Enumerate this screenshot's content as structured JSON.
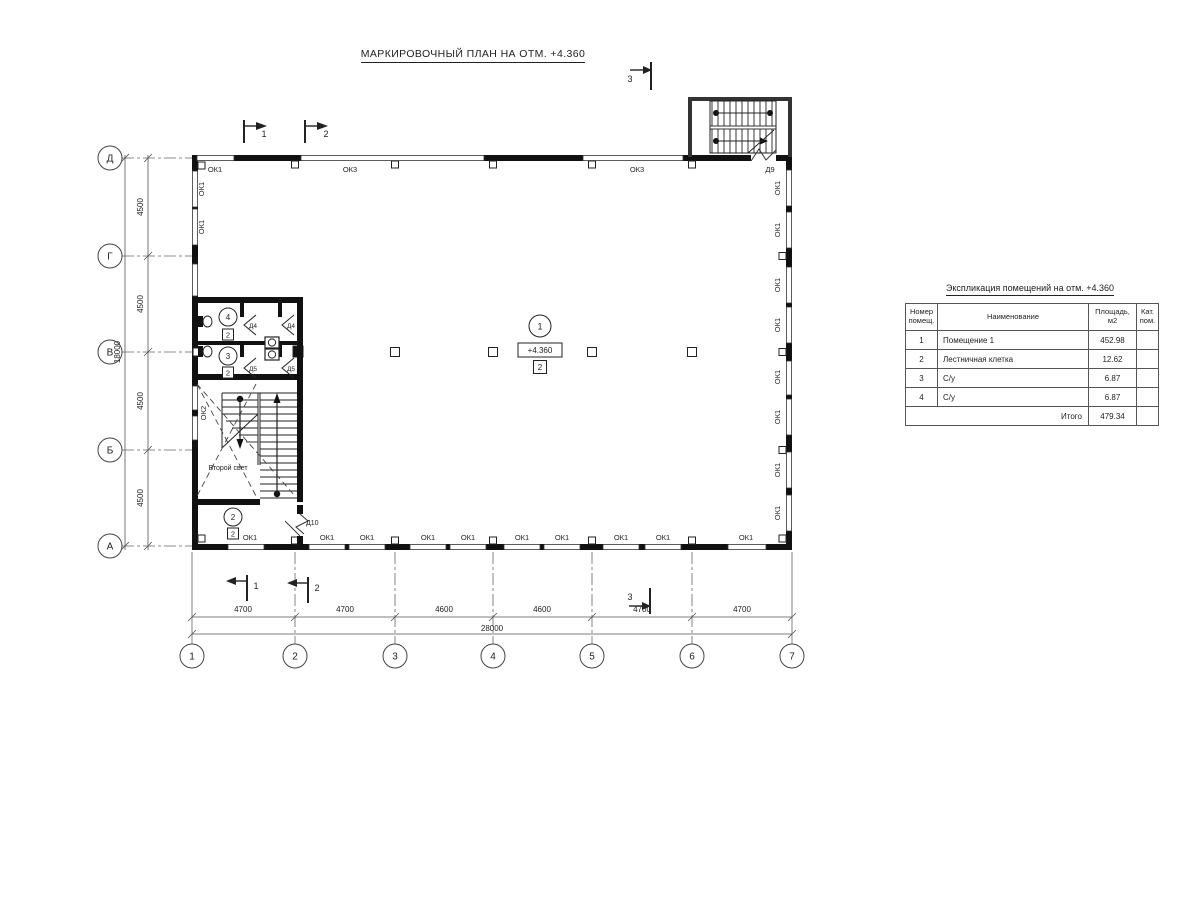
{
  "drawing": {
    "title": "МАРКИРОВОЧНЫЙ ПЛАН НА ОТМ. +4.360"
  },
  "plan": {
    "axes_rows": [
      "Д",
      "Г",
      "В",
      "Б",
      "А"
    ],
    "axes_cols": [
      "1",
      "2",
      "3",
      "4",
      "5",
      "6",
      "7"
    ],
    "dim_rows": [
      "4500",
      "4500",
      "4500",
      "4500"
    ],
    "dim_rows_total": "18000",
    "dim_cols": [
      "4700",
      "4700",
      "4600",
      "4600",
      "4700",
      "4700"
    ],
    "dim_cols_total": "28000",
    "sections": [
      "1",
      "2",
      "3"
    ],
    "windows": {
      "ok1": "ОК1",
      "ok2": "ОК2",
      "ok3": "ОК3"
    },
    "doors": {
      "d4": "Д4",
      "d5": "Д5",
      "d9": "Д9",
      "d10": "Д10"
    },
    "marks": {
      "hall": "1",
      "stair": "2",
      "wc_lower": "3",
      "wc_upper": "4",
      "category": "2",
      "elevation": "+4.360",
      "second_light": "Второй свет"
    }
  },
  "schedule": {
    "title": "Экспликация помещений на отм. +4.360",
    "col_num": "Номер помещ.",
    "col_name": "Наименование",
    "col_area": "Площадь, м2",
    "col_cat": "Кат. пом.",
    "rows": [
      {
        "num": "1",
        "name": "Помещение 1",
        "area": "452.98",
        "cat": ""
      },
      {
        "num": "2",
        "name": "Лестничная клетка",
        "area": "12.62",
        "cat": ""
      },
      {
        "num": "3",
        "name": "С/у",
        "area": "6.87",
        "cat": ""
      },
      {
        "num": "4",
        "name": "С/у",
        "area": "6.87",
        "cat": ""
      }
    ],
    "total_label": "Итого",
    "total_value": "479.34"
  }
}
